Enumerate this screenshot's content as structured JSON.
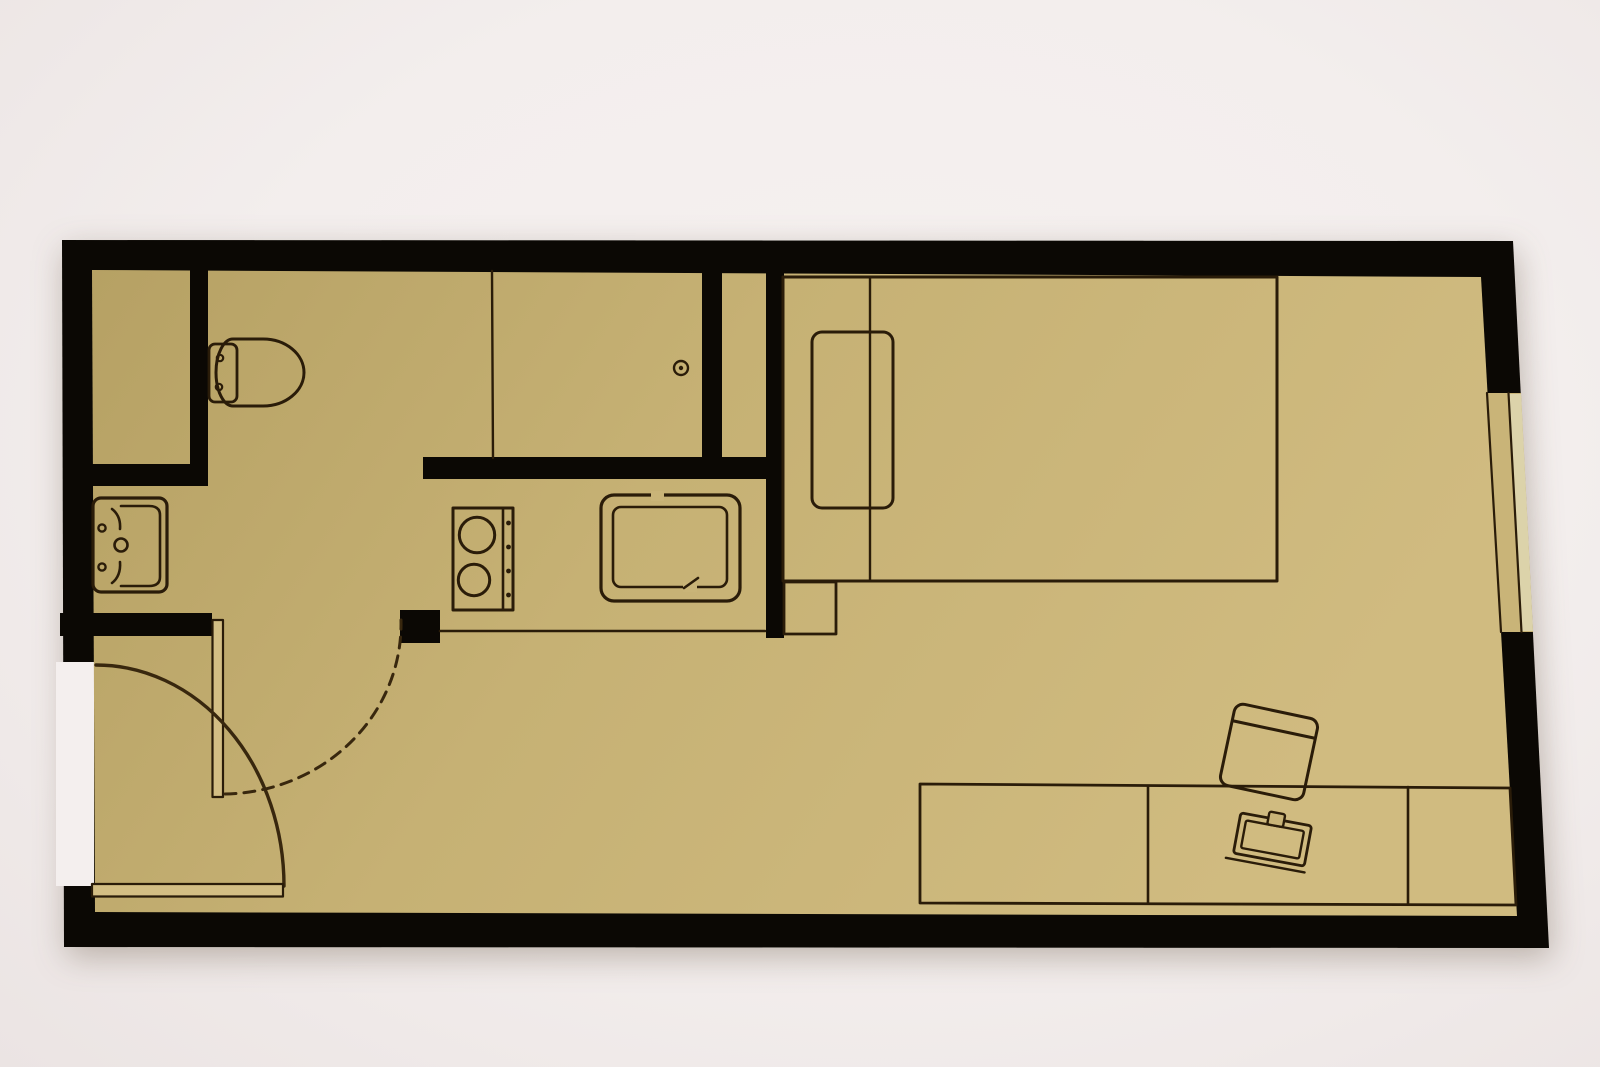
{
  "meta": {
    "title": "Studio apartment floor plan (top-down view)",
    "type": "floor-plan",
    "text_content": "none — drawing only, no visible text in image"
  },
  "scene": {
    "width": 1600,
    "height": 1067
  },
  "palette": {
    "bg": "#f4efee",
    "wall": "#0b0804",
    "floor": "url(#floorGrad)",
    "line": "#2a1c09",
    "arc": "#38270e",
    "leaf": "#d3be84",
    "pane": "#dcd3aa",
    "sill": "#c9b478"
  },
  "floor_gradient": {
    "from": "#b6a164",
    "mid": "#c6b174",
    "to": "#d0bb80"
  },
  "shapes": [
    {
      "name": "outer-walls",
      "kind": "polygon",
      "points": "62,240 1513,241 1549,948 64,947",
      "fill": "wall",
      "cls": "wall-shadow"
    },
    {
      "name": "entry-door-opening-gap",
      "kind": "polygon",
      "points": "56,662 94,662 94,886 56,886",
      "fill": "bg"
    },
    {
      "name": "floor",
      "kind": "polygon",
      "points": "92,270 1481,277 1517,916 95,912",
      "fill": "floor"
    },
    {
      "name": "shaft-right-wall",
      "kind": "rect",
      "x": 190,
      "y": 270,
      "w": 18,
      "h": 216,
      "fill": "wall"
    },
    {
      "name": "shaft-bottom-wall",
      "kind": "rect",
      "x": 91,
      "y": 464,
      "w": 117,
      "h": 22,
      "fill": "wall"
    },
    {
      "name": "bathroom-bottom-wall",
      "kind": "rect",
      "x": 60,
      "y": 613,
      "w": 152,
      "h": 23,
      "fill": "wall"
    },
    {
      "name": "kitchen-top-wall",
      "kind": "rect",
      "x": 423,
      "y": 457,
      "w": 360,
      "h": 22,
      "fill": "wall"
    },
    {
      "name": "shower-partition-wall",
      "kind": "rect",
      "x": 702,
      "y": 270,
      "w": 20,
      "h": 192,
      "fill": "wall"
    },
    {
      "name": "kitchen-bedroom-wall",
      "kind": "rect",
      "x": 766,
      "y": 270,
      "w": 18,
      "h": 368,
      "fill": "wall"
    },
    {
      "name": "kitchen-entry-stub-wall",
      "kind": "rect",
      "x": 400,
      "y": 610,
      "w": 40,
      "h": 33,
      "fill": "wall"
    },
    {
      "name": "window-opening",
      "kind": "polygon",
      "points": "1487,393 1521,393 1533,632 1501,632",
      "fill": "sill"
    },
    {
      "name": "window-pane",
      "kind": "polygon",
      "points": "1509,394 1521,394 1533,631 1522,631",
      "fill": "pane"
    },
    {
      "name": "window-frame-inner-line",
      "kind": "line",
      "x1": 1487,
      "y1": 393,
      "x2": 1501,
      "y2": 632,
      "stroke": "line",
      "sw": 2.2
    },
    {
      "name": "window-frame-mid-line",
      "kind": "line",
      "x1": 1508.5,
      "y1": 393,
      "x2": 1521.5,
      "y2": 632,
      "stroke": "line",
      "sw": 2.2
    },
    {
      "name": "shower-glass-line",
      "kind": "line",
      "x1": 492,
      "y1": 271,
      "x2": 493,
      "y2": 458,
      "stroke": "line",
      "sw": 2.4
    },
    {
      "name": "shower-drain",
      "kind": "circle",
      "cx": 681,
      "cy": 368,
      "r": 7,
      "stroke": "line",
      "sw": 2.4
    },
    {
      "name": "shower-drain-dot",
      "kind": "circle",
      "cx": 681,
      "cy": 368,
      "r": 2.2,
      "fill": "line"
    },
    {
      "name": "toilet-tank",
      "kind": "rect",
      "x": 209,
      "y": 344,
      "w": 28,
      "h": 58,
      "rx": 6,
      "stroke": "line",
      "sw": 2.8
    },
    {
      "name": "toilet-bowl",
      "kind": "path",
      "d": "M 233,339 L 263,339 A 41,33.5 0 0 1 263,406 L 233,406 A 17,33.5 0 0 1 233,339 Z",
      "stroke": "line",
      "sw": 3
    },
    {
      "name": "toilet-hinge-top",
      "kind": "circle",
      "cx": 220,
      "cy": 358,
      "r": 3.2,
      "stroke": "line",
      "sw": 2.2
    },
    {
      "name": "toilet-hinge-bottom",
      "kind": "circle",
      "cx": 219,
      "cy": 387,
      "r": 3.2,
      "stroke": "line",
      "sw": 2.2
    },
    {
      "name": "bathroom-sink-outer",
      "kind": "rect",
      "x": 93,
      "y": 498,
      "w": 74,
      "h": 94,
      "rx": 8,
      "stroke": "line",
      "sw": 3.2
    },
    {
      "name": "bathroom-sink-basin",
      "kind": "path",
      "d": "M 121,506 L 149,506 Q 160,506 160,515 L 160,577 Q 160,586 149,586 L 121,586",
      "stroke": "line",
      "sw": 2.6
    },
    {
      "name": "basin-corner-curve-top",
      "kind": "path",
      "d": "M 112,509 Q 121,516 120,529",
      "stroke": "line",
      "sw": 2.6
    },
    {
      "name": "basin-corner-curve-bottom",
      "kind": "path",
      "d": "M 112,583 Q 121,576 120,562",
      "stroke": "line",
      "sw": 2.6
    },
    {
      "name": "faucet-knob-top",
      "kind": "circle",
      "cx": 102,
      "cy": 528,
      "r": 3.6,
      "stroke": "line",
      "sw": 2.4
    },
    {
      "name": "faucet-knob-bottom",
      "kind": "circle",
      "cx": 102,
      "cy": 567,
      "r": 3.6,
      "stroke": "line",
      "sw": 2.4
    },
    {
      "name": "bathroom-sink-drain",
      "kind": "circle",
      "cx": 121,
      "cy": 545,
      "r": 6.5,
      "stroke": "line",
      "sw": 2.6
    },
    {
      "name": "stove-outline",
      "kind": "rect",
      "x": 453,
      "y": 508,
      "w": 60,
      "h": 102,
      "stroke": "line",
      "sw": 3
    },
    {
      "name": "stove-control-divider",
      "kind": "line",
      "x1": 503,
      "y1": 509,
      "x2": 503,
      "y2": 609,
      "stroke": "line",
      "sw": 2.6
    },
    {
      "name": "stove-knob-1",
      "kind": "circle",
      "cx": 508.5,
      "cy": 523,
      "r": 2.4,
      "fill": "line"
    },
    {
      "name": "stove-knob-2",
      "kind": "circle",
      "cx": 508.5,
      "cy": 547,
      "r": 2.4,
      "fill": "line"
    },
    {
      "name": "stove-knob-3",
      "kind": "circle",
      "cx": 508.5,
      "cy": 571,
      "r": 2.4,
      "fill": "line"
    },
    {
      "name": "stove-knob-4",
      "kind": "circle",
      "cx": 508.5,
      "cy": 595,
      "r": 2.4,
      "fill": "line"
    },
    {
      "name": "stove-burner-large",
      "kind": "circle",
      "cx": 477,
      "cy": 535,
      "r": 17.7,
      "stroke": "line",
      "sw": 3
    },
    {
      "name": "stove-burner-small",
      "kind": "circle",
      "cx": 474,
      "cy": 580,
      "r": 15.7,
      "stroke": "line",
      "sw": 3
    },
    {
      "name": "kitchen-sink-outer",
      "kind": "rect",
      "x": 601,
      "y": 495,
      "w": 139,
      "h": 106,
      "rx": 13,
      "stroke": "line",
      "sw": 3.2
    },
    {
      "name": "kitchen-sink-inner",
      "kind": "rect",
      "x": 613,
      "y": 507,
      "w": 114,
      "h": 80,
      "rx": 8,
      "stroke": "line",
      "sw": 2.6
    },
    {
      "name": "kitchen-sink-gap-patch",
      "kind": "rect",
      "x": 651,
      "y": 491,
      "w": 13,
      "h": 10,
      "fill": "sill"
    },
    {
      "name": "kitchen-sink-notch-patch",
      "kind": "rect",
      "x": 683,
      "y": 582,
      "w": 14,
      "h": 10,
      "fill": "sill"
    },
    {
      "name": "kitchen-sink-faucet-notch",
      "kind": "line",
      "x1": 684,
      "y1": 588,
      "x2": 698,
      "y2": 578,
      "stroke": "line",
      "sw": 2.6
    },
    {
      "name": "counter-front-edge",
      "kind": "line",
      "x1": 440,
      "y1": 631,
      "x2": 765,
      "y2": 631,
      "stroke": "line",
      "sw": 2.6
    },
    {
      "name": "bed-outline",
      "kind": "rect",
      "x": 783,
      "y": 277,
      "w": 494,
      "h": 304,
      "stroke": "line",
      "sw": 3
    },
    {
      "name": "bed-headboard-line",
      "kind": "line",
      "x1": 870,
      "y1": 278,
      "x2": 870,
      "y2": 580,
      "stroke": "line",
      "sw": 2.4
    },
    {
      "name": "bed-pillow",
      "kind": "rect",
      "x": 812,
      "y": 332,
      "w": 81,
      "h": 176,
      "rx": 10,
      "stroke": "line",
      "sw": 3
    },
    {
      "name": "nightstand",
      "kind": "rect",
      "x": 784,
      "y": 582,
      "w": 52,
      "h": 52,
      "stroke": "line",
      "sw": 2.8
    },
    {
      "name": "desk-outline",
      "kind": "polygon",
      "points": "920,784 1510,788 1516,905 920,903",
      "stroke": "line",
      "sw": 2.8
    },
    {
      "name": "desk-divider-left",
      "kind": "line",
      "x1": 1148,
      "y1": 786,
      "x2": 1148,
      "y2": 903,
      "stroke": "line",
      "sw": 2.6
    },
    {
      "name": "desk-divider-right",
      "kind": "line",
      "x1": 1408,
      "y1": 787,
      "x2": 1408,
      "y2": 904,
      "stroke": "line",
      "sw": 2.6
    },
    {
      "name": "desk-chair-seat",
      "kind": "rect",
      "x": 1226.5,
      "y": 710.5,
      "w": 85,
      "h": 83,
      "rx": 9,
      "stroke": "line",
      "sw": 3,
      "transform": "rotate(12 1269 752)"
    },
    {
      "name": "desk-chair-backrest",
      "kind": "line",
      "x1": 1227,
      "y1": 729,
      "x2": 1311,
      "y2": 729,
      "stroke": "line",
      "sw": 3,
      "transform": "rotate(12 1269 752)"
    },
    {
      "name": "laptop-base-lip",
      "kind": "line",
      "x1": 1230,
      "y1": 866,
      "x2": 1310,
      "y2": 866,
      "stroke": "line",
      "sw": 2.4,
      "transform": "rotate(10.5 1272.5 839.5)"
    },
    {
      "name": "laptop-outline",
      "kind": "rect",
      "x": 1236.5,
      "y": 819,
      "w": 72,
      "h": 41,
      "rx": 3,
      "stroke": "line",
      "sw": 2.8,
      "transform": "rotate(10.5 1272.5 839.5)"
    },
    {
      "name": "laptop-screen",
      "kind": "rect",
      "x": 1243,
      "y": 825.5,
      "w": 59,
      "h": 28,
      "rx": 2,
      "stroke": "line",
      "sw": 2.4,
      "transform": "rotate(10.5 1272.5 839.5)"
    },
    {
      "name": "laptop-camera-tab",
      "kind": "rect",
      "x": 1264.5,
      "y": 812.5,
      "w": 16,
      "h": 13,
      "rx": 2,
      "fill": "sill",
      "stroke": "line",
      "sw": 2.4,
      "transform": "rotate(10.5 1272.5 839.5)"
    },
    {
      "name": "bathroom-door-leaf",
      "kind": "rect",
      "x": 212.5,
      "y": 620,
      "w": 10.5,
      "h": 177,
      "fill": "leaf",
      "stroke": "line",
      "sw": 2.2
    },
    {
      "name": "bathroom-door-swing-arc",
      "kind": "path",
      "d": "M 225,794 A 179,170 0 0 0 401,620",
      "stroke": "arc",
      "sw": 3,
      "dash": "11 8"
    },
    {
      "name": "entry-door-swing-arc",
      "kind": "path",
      "d": "M 96,665 A 188,221 0 0 1 284,886",
      "stroke": "arc",
      "sw": 3.4
    },
    {
      "name": "entry-door-leaf",
      "kind": "rect",
      "x": 92,
      "y": 884,
      "w": 191,
      "h": 12.5,
      "fill": "leaf",
      "stroke": "line",
      "sw": 2.2
    }
  ]
}
